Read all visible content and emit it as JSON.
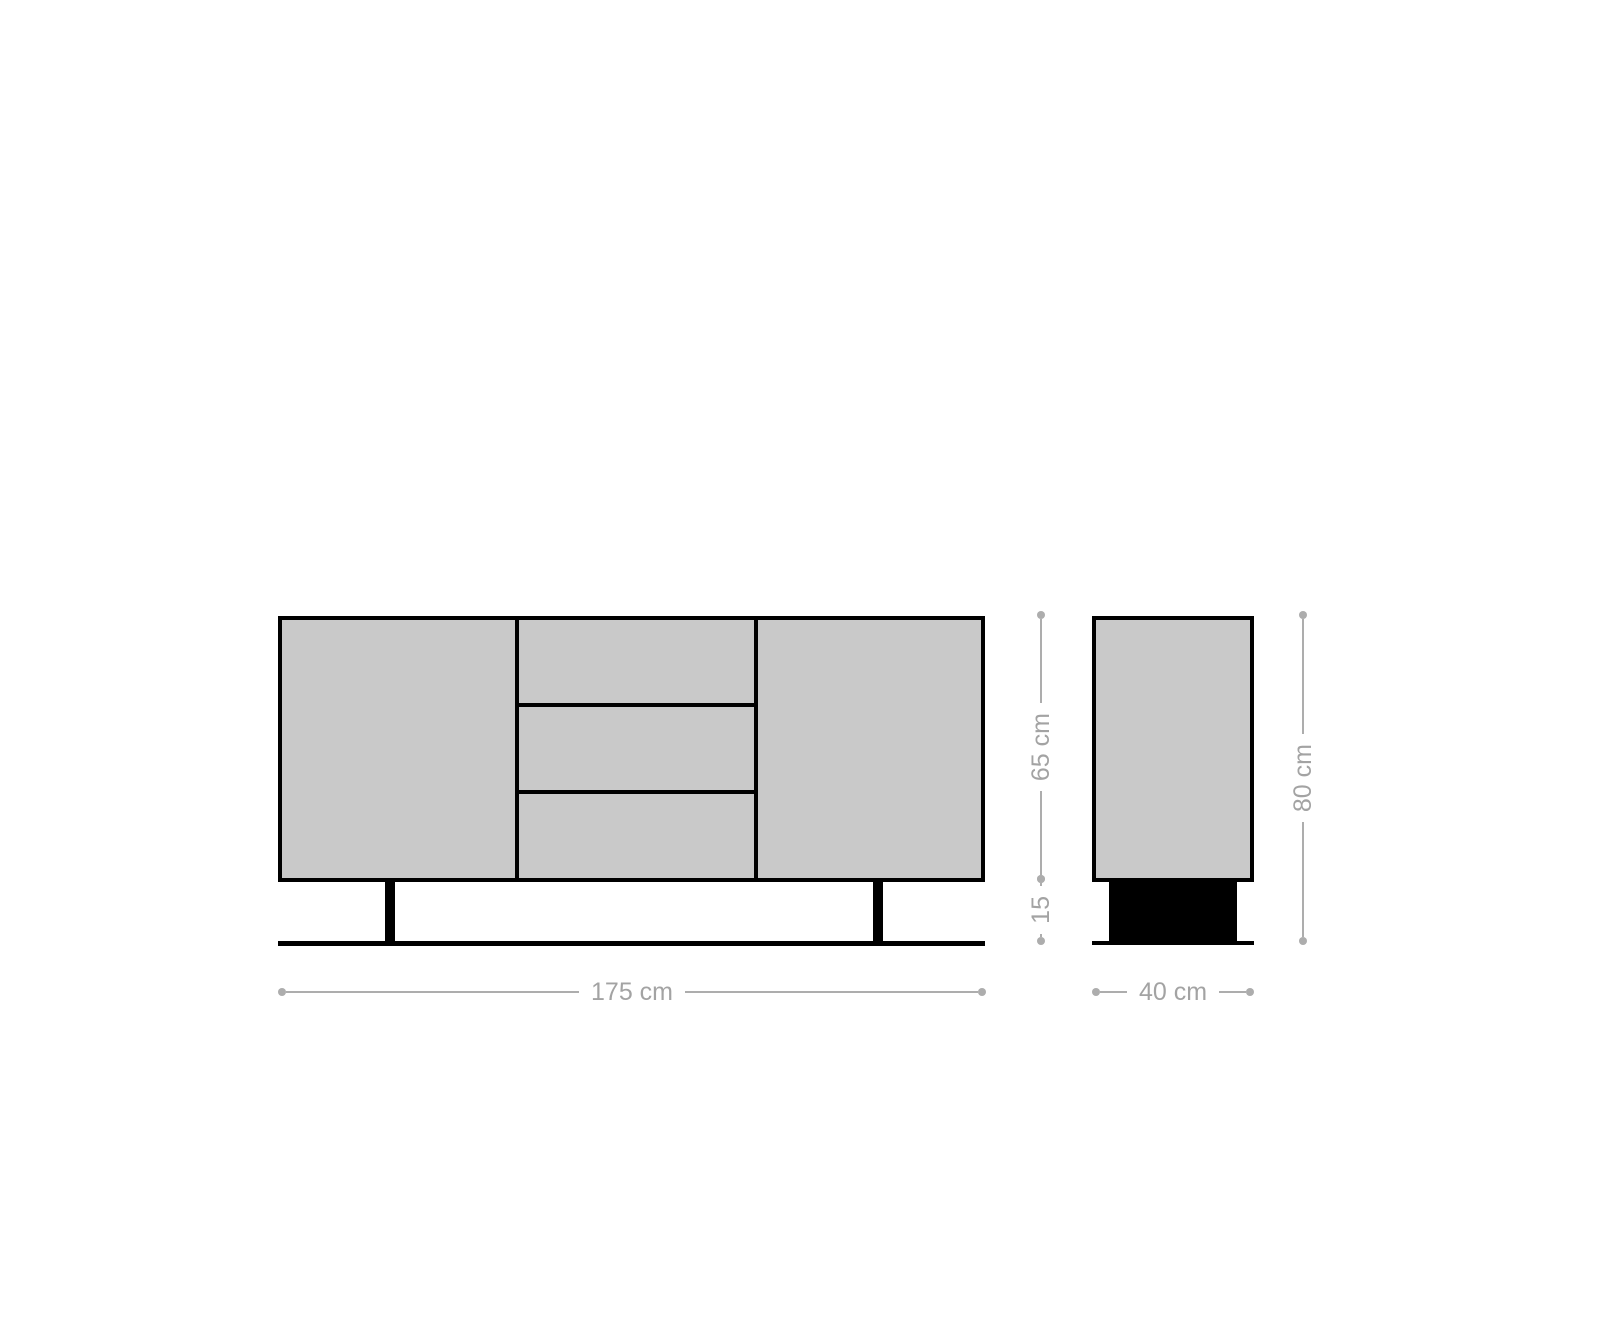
{
  "diagram": {
    "dimension_labels": {
      "front_width": "175 cm",
      "side_depth": "40 cm",
      "cabinet_height": "65 cm",
      "base_height": "15",
      "total_height": "80 cm"
    },
    "colors": {
      "panel_fill": "#c9c9c9",
      "outline": "#000000",
      "base_fill": "#000000",
      "dimension_line": "#adadad",
      "dimension_text": "#a3a3a3",
      "background": "#ffffff"
    }
  }
}
